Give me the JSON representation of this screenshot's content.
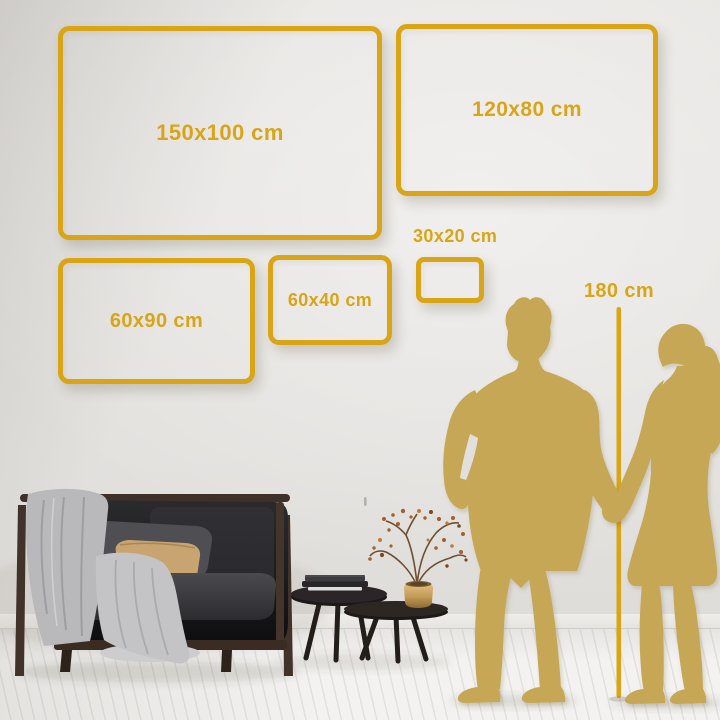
{
  "size_guide": {
    "frames": [
      {
        "label": "150x100 cm"
      },
      {
        "label": "120x80 cm"
      },
      {
        "label": "60x90 cm"
      },
      {
        "label": "60x40 cm"
      },
      {
        "label": "30x20 cm"
      }
    ],
    "height_reference": {
      "label": "180 cm"
    }
  },
  "colors": {
    "gold": "#D9A516",
    "silhouette": "#C6A757",
    "wall": "#E4E2DF",
    "floor": "#F3F2F0",
    "sofa_dark": "#1A1A1D",
    "wood": "#42332A",
    "blanket_gray": "#B9B9BB",
    "pillow_gray": "#4E4E53",
    "pillow_tan": "#C8A470",
    "vase_brass": "#C29A55",
    "blossom_rust": "#A55F2E"
  },
  "scene_objects": [
    "man-silhouette",
    "woman-silhouette",
    "height-ruler-line",
    "sofa-with-draped-blanket",
    "lumbar-pillows",
    "nesting-coffee-tables",
    "stacked-books",
    "brass-vase-with-branch",
    "plank-floor",
    "wall"
  ]
}
